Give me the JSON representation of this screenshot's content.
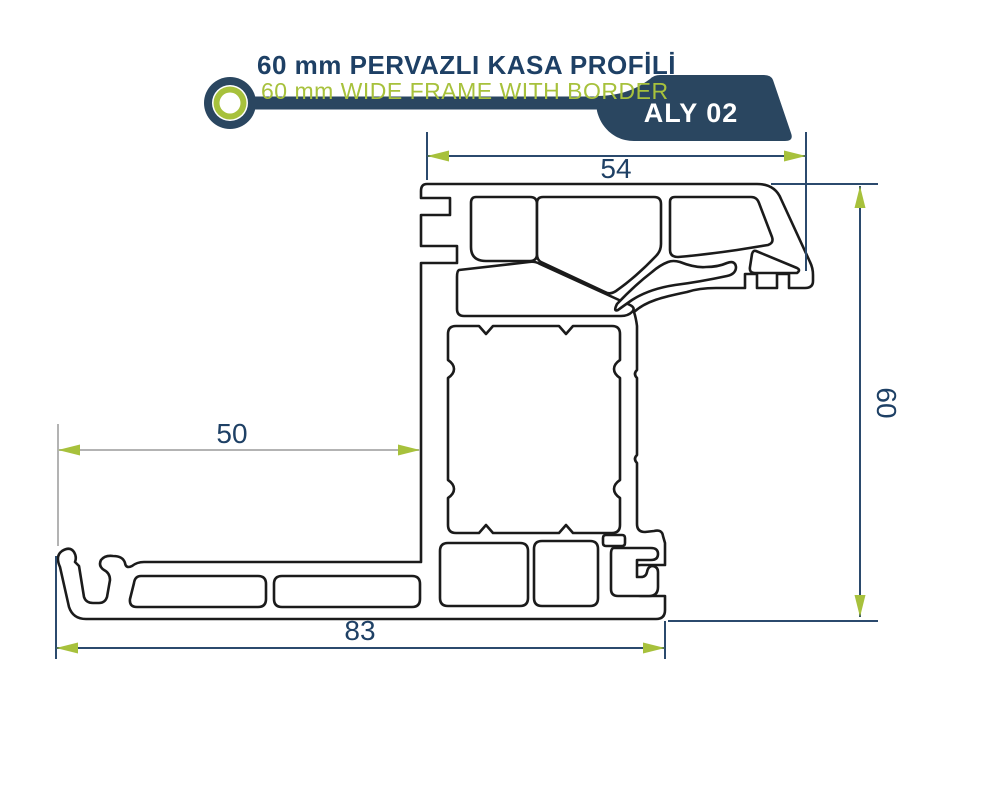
{
  "header": {
    "title": "60 mm PERVAZLI KASA PROFİLİ",
    "subtitle": "60 mm WIDE FRAME WITH BORDER",
    "badge": "ALY 02",
    "logo_icon": "concentric-rings-logo"
  },
  "drawing": {
    "type": "technical-profile-cross-section",
    "description": "Cross section of 60 mm wide frame profile with border, with outer silhouette and internal chambers",
    "dimensions": {
      "top": "54",
      "right": "60",
      "left": "50",
      "bottom": "83"
    }
  },
  "colors": {
    "navy": "#2b4a6d",
    "navy_text": "#1e4065",
    "green": "#a7c13c",
    "gray": "#b3b3b3",
    "outline": "#1b1b1b",
    "banner": "#2a4660"
  }
}
